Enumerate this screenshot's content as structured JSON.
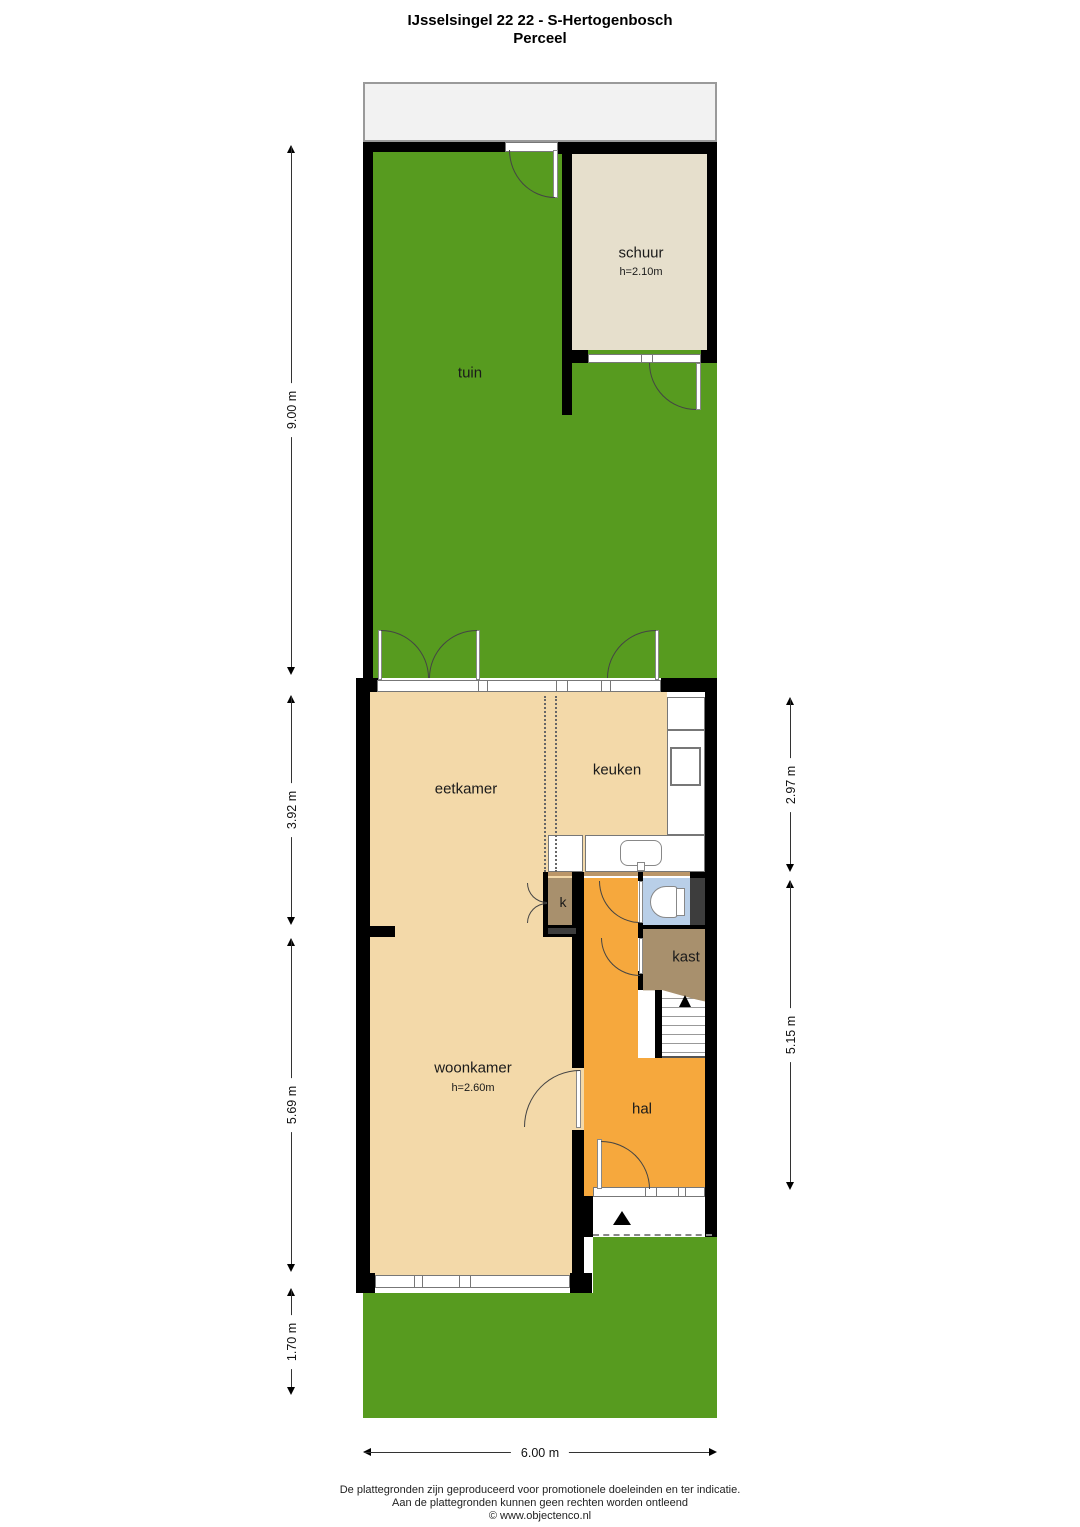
{
  "title": {
    "line1": "IJsselsingel 22 22 - S-Hertogenbosch",
    "line2": "Perceel"
  },
  "rooms": {
    "tuin": {
      "label": "tuin"
    },
    "schuur": {
      "label": "schuur",
      "height": "h=2.10m"
    },
    "eetkamer": {
      "label": "eetkamer"
    },
    "keuken": {
      "label": "keuken"
    },
    "woonkamer": {
      "label": "woonkamer",
      "height": "h=2.60m"
    },
    "hal": {
      "label": "hal"
    },
    "kast": {
      "label": "kast"
    },
    "k": {
      "label": "k"
    }
  },
  "dimensions": {
    "left": [
      {
        "label": "9.00 m"
      },
      {
        "label": "3.92 m"
      },
      {
        "label": "5.69 m"
      },
      {
        "label": "1.70 m"
      }
    ],
    "right": [
      {
        "label": "2.97 m"
      },
      {
        "label": "5.15 m"
      }
    ],
    "bottom": [
      {
        "label": "6.00 m"
      }
    ]
  },
  "footer": {
    "line1": "De plattegronden zijn geproduceerd voor promotionele doeleinden en ter indicatie.",
    "line2": "Aan de plattegronden kunnen geen rechten worden ontleend",
    "line3": "© www.objectenco.nl"
  },
  "colors": {
    "garden": "#579b1f",
    "floor": "#f3d9a9",
    "shed_floor": "#e6dfcc",
    "hall": "#f6a83d",
    "closet": "#a8906d",
    "toilet": "#b9cfe8",
    "pavement": "#f2f2f2",
    "shaft": "#3d3d3d",
    "wall": "#000000"
  }
}
